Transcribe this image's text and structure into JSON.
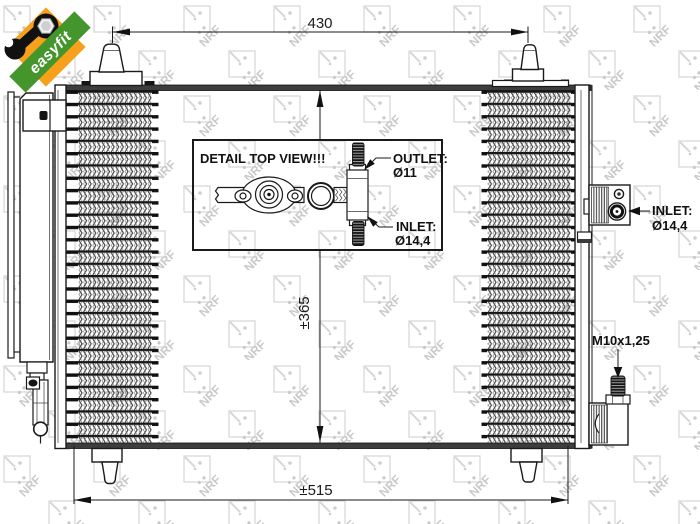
{
  "watermark": {
    "text": "NRF",
    "color": "#c9c9c9"
  },
  "logo": {
    "ribbon_text": "easyfit",
    "orange": "#F6A01B",
    "green": "#44962C"
  },
  "dimensions": {
    "top_width": "430",
    "core_height": "±365",
    "overall_width": "±515"
  },
  "detail_box": {
    "title": "DETAIL TOP VIEW!!!",
    "outlet_label": "OUTLET:",
    "outlet_value": "Ø11",
    "inlet_label": "INLET:",
    "inlet_value": "Ø14,4"
  },
  "side_annotations": {
    "inlet_label": "INLET:",
    "inlet_value": "Ø14,4",
    "thread_spec": "M10x1,25"
  }
}
